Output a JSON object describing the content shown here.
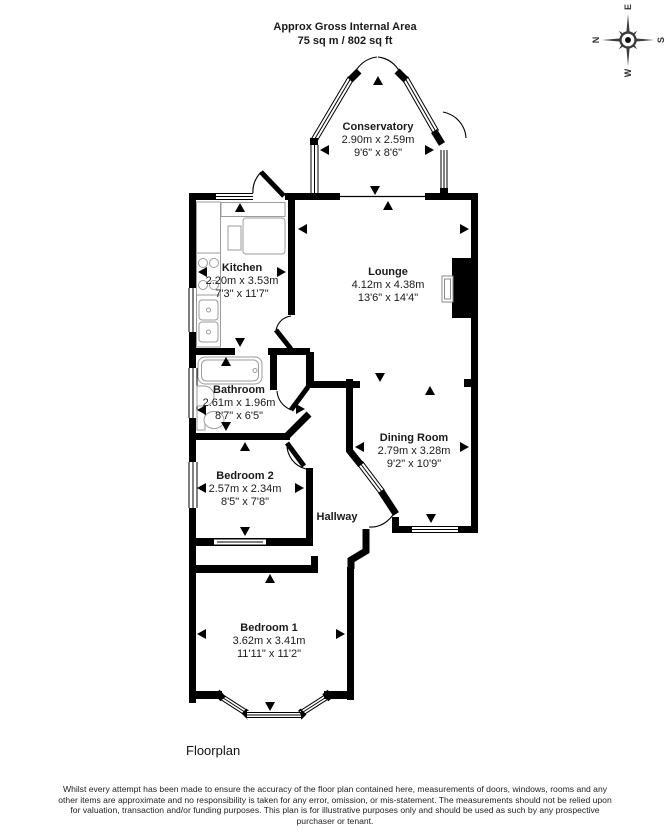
{
  "header": {
    "title_line1": "Approx Gross Internal Area",
    "title_line2": "75 sq m / 802 sq ft"
  },
  "compass": {
    "north": "N",
    "east": "E",
    "south": "S",
    "west": "W"
  },
  "rooms": {
    "conservatory": {
      "name": "Conservatory",
      "metric": "2.90m x 2.59m",
      "imperial": "9'6\" x 8'6\""
    },
    "kitchen": {
      "name": "Kitchen",
      "metric": "2.20m x 3.53m",
      "imperial": "7'3\" x 11'7\""
    },
    "lounge": {
      "name": "Lounge",
      "metric": "4.12m x 4.38m",
      "imperial": "13'6\" x 14'4\""
    },
    "bathroom": {
      "name": "Bathroom",
      "metric": "2.61m x 1.96m",
      "imperial": "8'7\" x 6'5\""
    },
    "dining_room": {
      "name": "Dining Room",
      "metric": "2.79m x 3.28m",
      "imperial": "9'2\" x 10'9\""
    },
    "bedroom2": {
      "name": "Bedroom 2",
      "metric": "2.57m x 2.34m",
      "imperial": "8'5\" x 7'8\""
    },
    "hallway": {
      "name": "Hallway"
    },
    "bedroom1": {
      "name": "Bedroom 1",
      "metric": "3.62m x 3.41m",
      "imperial": "11'11\" x 11'2\""
    }
  },
  "caption": "Floorplan",
  "disclaimer": "Whilst every attempt has been made to ensure the accuracy of the floor plan contained here, measurements of doors, windows, rooms and any other items are approximate and no responsibility is taken for any error, omission, or mis-statement. The measurements should not be relied upon for valuation, transaction and/or funding purposes. This plan is for illustrative purposes only and should be used as such by any prospective purchaser or tenant.",
  "colors": {
    "wall": "#000000",
    "fixture": "#999999",
    "compass": "#3d3d3d"
  }
}
